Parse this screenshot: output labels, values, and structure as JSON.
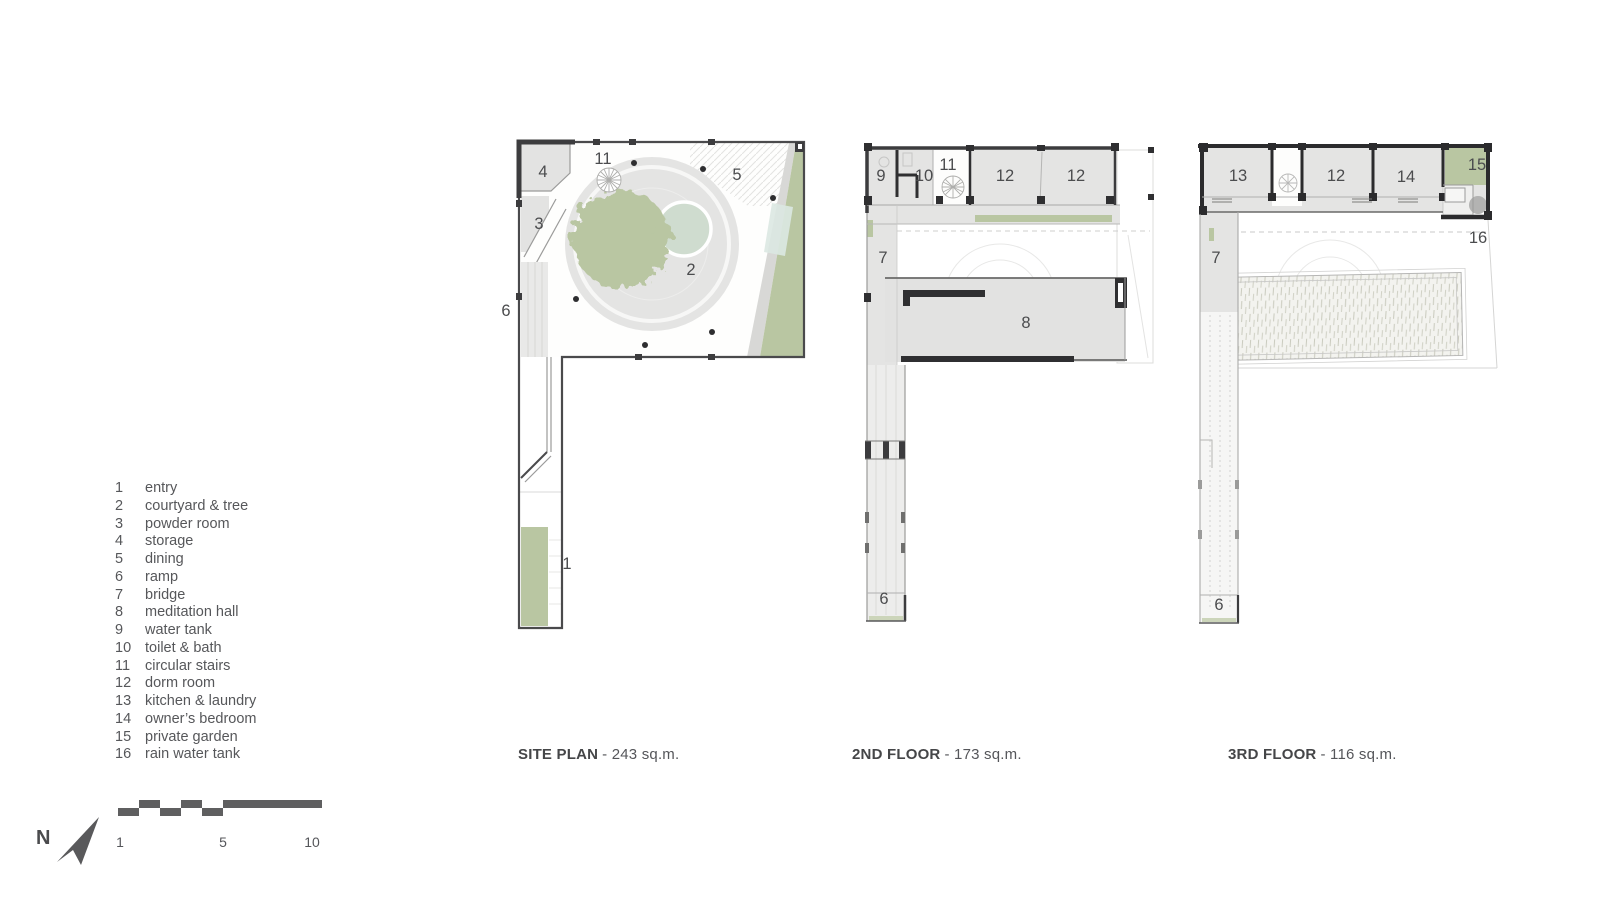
{
  "colors": {
    "wall_dark": "#2f2f31",
    "outline": "#4a4a4c",
    "room_fill": "#e4e4e3",
    "green": "#b9c6a2",
    "pool": "#cfdccf",
    "water_accent": "#dce8e2",
    "label_text": "#4b4c4e"
  },
  "legend": {
    "items": [
      {
        "n": "1",
        "label": "entry"
      },
      {
        "n": "2",
        "label": "courtyard & tree"
      },
      {
        "n": "3",
        "label": "powder room"
      },
      {
        "n": "4",
        "label": "storage"
      },
      {
        "n": "5",
        "label": "dining"
      },
      {
        "n": "6",
        "label": "ramp"
      },
      {
        "n": "7",
        "label": "bridge"
      },
      {
        "n": "8",
        "label": "meditation hall"
      },
      {
        "n": "9",
        "label": "water tank"
      },
      {
        "n": "10",
        "label": "toilet & bath"
      },
      {
        "n": "11",
        "label": "circular stairs"
      },
      {
        "n": "12",
        "label": "dorm room"
      },
      {
        "n": "13",
        "label": "kitchen & laundry"
      },
      {
        "n": "14",
        "label": "owner’s bedroom"
      },
      {
        "n": "15",
        "label": "private garden"
      },
      {
        "n": "16",
        "label": "rain water tank"
      }
    ]
  },
  "plans": {
    "site": {
      "title": "SITE PLAN",
      "area": "- 243 sq.m.",
      "labels": [
        "4",
        "3",
        "11",
        "5",
        "2",
        "6",
        "1"
      ]
    },
    "second": {
      "title": "2ND FLOOR",
      "area": "- 173 sq.m.",
      "labels": [
        "9",
        "10",
        "11",
        "12",
        "12",
        "7",
        "8",
        "6"
      ]
    },
    "third": {
      "title": "3RD FLOOR",
      "area": "- 116 sq.m.",
      "labels": [
        "13",
        "12",
        "14",
        "15",
        "16",
        "7",
        "6"
      ]
    }
  },
  "compass": {
    "label": "N"
  },
  "scalebar": {
    "labels": [
      "1",
      "5",
      "10"
    ]
  }
}
